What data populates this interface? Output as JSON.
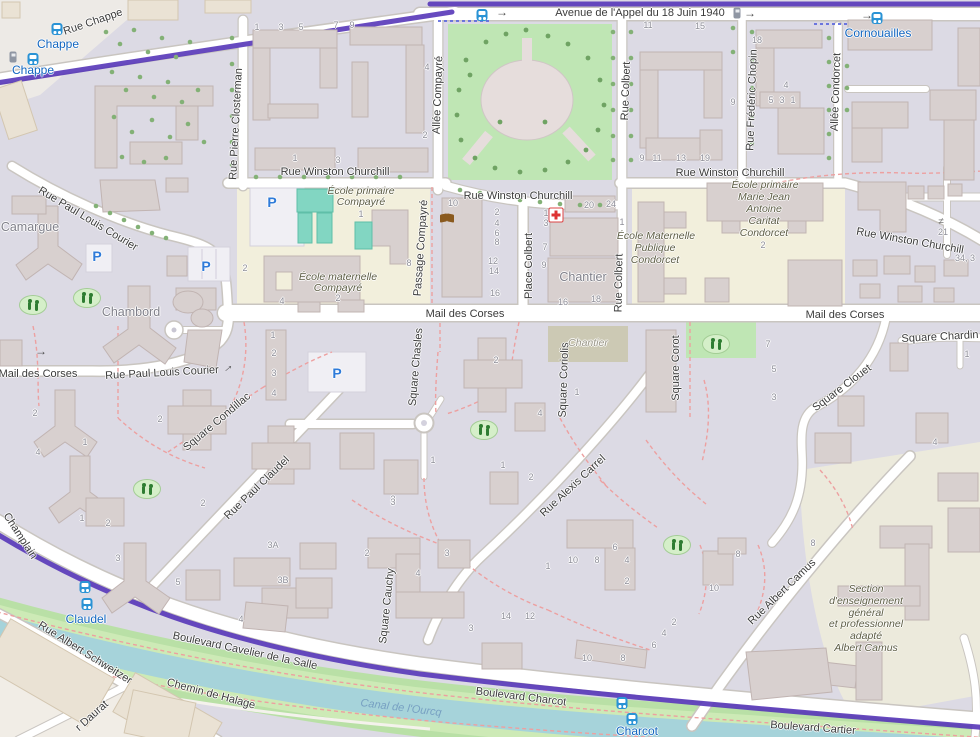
{
  "map": {
    "colors": {
      "residential": "#dcdae4",
      "route_purple": "#5636b8",
      "water": "#a6d3da",
      "park_green": "#bfe6b4",
      "school_beige": "#f2efdc",
      "pitch_teal": "#82d6c2",
      "stop_blue": "#1266c0",
      "building_gray": "#d8d0cf",
      "footpath_red": "#eda0a0"
    },
    "labels": {
      "streets": [
        {
          "t": "Avenue de l'Appel du 18 Juin 1940",
          "x": 640,
          "y": 13,
          "r": 0
        },
        {
          "t": "Rue Chappe",
          "x": 93,
          "y": 22,
          "r": -19
        },
        {
          "t": "Rue Pierre Closterman",
          "x": 236,
          "y": 124,
          "r": -87
        },
        {
          "t": "Allée Compayré",
          "x": 438,
          "y": 95,
          "r": -88
        },
        {
          "t": "Rue Winston Churchill",
          "x": 335,
          "y": 172,
          "r": 0
        },
        {
          "t": "Rue Winston Churchill",
          "x": 518,
          "y": 196,
          "r": 0
        },
        {
          "t": "Rue Winston Churchill",
          "x": 730,
          "y": 173,
          "r": 0
        },
        {
          "t": "Rue Winston Churchill",
          "x": 910,
          "y": 241,
          "r": 10
        },
        {
          "t": "Rue Colbert",
          "x": 626,
          "y": 91,
          "r": -88
        },
        {
          "t": "Rue Colbert",
          "x": 619,
          "y": 283,
          "r": -89
        },
        {
          "t": "Rue Frédéric Chopin",
          "x": 752,
          "y": 100,
          "r": -88
        },
        {
          "t": "Allée Condorcet",
          "x": 836,
          "y": 92,
          "r": -88
        },
        {
          "t": "Place Colbert",
          "x": 529,
          "y": 266,
          "r": -90
        },
        {
          "t": "Passage Compayré",
          "x": 421,
          "y": 248,
          "r": -86
        },
        {
          "t": "Mail des Corses",
          "x": 465,
          "y": 314,
          "r": 0
        },
        {
          "t": "Mail des Corses",
          "x": 845,
          "y": 315,
          "r": 0
        },
        {
          "t": "Mail des Corses",
          "x": 38,
          "y": 374,
          "r": 0
        },
        {
          "t": "Rue Paul Louis Courier",
          "x": 88,
          "y": 219,
          "r": 31
        },
        {
          "t": "Rue Paul Louis Courier",
          "x": 162,
          "y": 373,
          "r": -3
        },
        {
          "t": "Square Chardin",
          "x": 940,
          "y": 337,
          "r": -3
        },
        {
          "t": "Square Clouet",
          "x": 842,
          "y": 388,
          "r": -37
        },
        {
          "t": "Square Corot",
          "x": 676,
          "y": 368,
          "r": -90
        },
        {
          "t": "Square Condillac",
          "x": 217,
          "y": 422,
          "r": -40
        },
        {
          "t": "Rue Paul Claudel",
          "x": 257,
          "y": 488,
          "r": -44
        },
        {
          "t": "Square Chasles",
          "x": 416,
          "y": 367,
          "r": -85
        },
        {
          "t": "Square Coriolis",
          "x": 564,
          "y": 380,
          "r": -88
        },
        {
          "t": "Square Cauchy",
          "x": 387,
          "y": 606,
          "r": -84
        },
        {
          "t": "Rue Alexis Carrel",
          "x": 573,
          "y": 486,
          "r": -43
        },
        {
          "t": "Rue Albert Camus",
          "x": 782,
          "y": 592,
          "r": -44
        },
        {
          "t": "Boulevard Cavelier de la Salle",
          "x": 245,
          "y": 651,
          "r": 12
        },
        {
          "t": "Boulevard Charcot",
          "x": 521,
          "y": 697,
          "r": 7
        },
        {
          "t": "Boulevard Cartier",
          "x": 813,
          "y": 728,
          "r": 4
        },
        {
          "t": "Chemin de Halage",
          "x": 211,
          "y": 694,
          "r": 15
        },
        {
          "t": "Rue Albert Schweitzer",
          "x": 85,
          "y": 653,
          "r": 32
        },
        {
          "t": "r Daurat",
          "x": 92,
          "y": 716,
          "r": -42
        },
        {
          "t": "Champlain",
          "x": 20,
          "y": 536,
          "r": 57
        }
      ],
      "water": [
        {
          "t": "Canal de l'Ourcq",
          "x": 401,
          "y": 708,
          "r": 7
        }
      ],
      "places": [
        {
          "t": "Camargue",
          "x": 30,
          "y": 227,
          "r": 0
        },
        {
          "t": "Chambord",
          "x": 131,
          "y": 312,
          "r": 0
        },
        {
          "t": "Chantier",
          "x": 583,
          "y": 277,
          "r": 0
        }
      ],
      "areas": [
        {
          "t": "Chantier",
          "x": 588,
          "y": 343,
          "r": 0
        }
      ],
      "schools": [
        {
          "t": "École primaire",
          "x": 361,
          "y": 191,
          "r": 0
        },
        {
          "t": "Compayré",
          "x": 361,
          "y": 202,
          "r": 0
        },
        {
          "t": "École maternelle",
          "x": 338,
          "y": 277,
          "r": 0
        },
        {
          "t": "Compayré",
          "x": 338,
          "y": 288,
          "r": 0
        },
        {
          "t": "École Maternelle",
          "x": 656,
          "y": 236,
          "r": 0
        },
        {
          "t": "Publique",
          "x": 655,
          "y": 248,
          "r": 0
        },
        {
          "t": "Condorcet",
          "x": 655,
          "y": 260,
          "r": 0
        },
        {
          "t": "École primaire",
          "x": 765,
          "y": 185,
          "r": 0
        },
        {
          "t": "Marie Jean",
          "x": 764,
          "y": 197,
          "r": 0
        },
        {
          "t": "Antoine",
          "x": 764,
          "y": 209,
          "r": 0
        },
        {
          "t": "Caritat",
          "x": 764,
          "y": 221,
          "r": 0
        },
        {
          "t": "Condorcet",
          "x": 764,
          "y": 233,
          "r": 0
        },
        {
          "t": "Section",
          "x": 866,
          "y": 589,
          "r": 0
        },
        {
          "t": "d'enseignement",
          "x": 866,
          "y": 601,
          "r": 0
        },
        {
          "t": "général",
          "x": 866,
          "y": 613,
          "r": 0
        },
        {
          "t": "et professionnel",
          "x": 866,
          "y": 624,
          "r": 0
        },
        {
          "t": "adapté",
          "x": 866,
          "y": 636,
          "r": 0
        },
        {
          "t": "Albert Camus",
          "x": 866,
          "y": 648,
          "r": 0
        }
      ],
      "stops": [
        {
          "t": "Chappe",
          "x": 58,
          "y": 44,
          "r": 0
        },
        {
          "t": "Chappe",
          "x": 33,
          "y": 70,
          "r": 0
        },
        {
          "t": "Cornouailles",
          "x": 878,
          "y": 33,
          "r": 0
        },
        {
          "t": "Claudel",
          "x": 86,
          "y": 619,
          "r": 0
        },
        {
          "t": "Charcot",
          "x": 637,
          "y": 731,
          "r": 0
        }
      ],
      "numbers": [
        {
          "t": "1",
          "x": 257,
          "y": 27
        },
        {
          "t": "3",
          "x": 281,
          "y": 27
        },
        {
          "t": "5",
          "x": 301,
          "y": 27
        },
        {
          "t": "7",
          "x": 336,
          "y": 25
        },
        {
          "t": "9",
          "x": 352,
          "y": 25
        },
        {
          "t": "4",
          "x": 427,
          "y": 67
        },
        {
          "t": "2",
          "x": 425,
          "y": 135
        },
        {
          "t": "1",
          "x": 295,
          "y": 158
        },
        {
          "t": "3",
          "x": 338,
          "y": 160
        },
        {
          "t": "11",
          "x": 648,
          "y": 25
        },
        {
          "t": "15",
          "x": 700,
          "y": 26
        },
        {
          "t": "9",
          "x": 642,
          "y": 158
        },
        {
          "t": "11",
          "x": 657,
          "y": 158
        },
        {
          "t": "13",
          "x": 681,
          "y": 158
        },
        {
          "t": "19",
          "x": 705,
          "y": 158
        },
        {
          "t": "9",
          "x": 733,
          "y": 102
        },
        {
          "t": "18",
          "x": 757,
          "y": 40
        },
        {
          "t": "4",
          "x": 786,
          "y": 85
        },
        {
          "t": "5",
          "x": 771,
          "y": 100
        },
        {
          "t": "3",
          "x": 782,
          "y": 100
        },
        {
          "t": "1",
          "x": 793,
          "y": 100
        },
        {
          "t": "21",
          "x": 943,
          "y": 232
        },
        {
          "t": "34, 3",
          "x": 965,
          "y": 258
        },
        {
          "t": "1",
          "x": 361,
          "y": 214
        },
        {
          "t": "2",
          "x": 338,
          "y": 298
        },
        {
          "t": "4",
          "x": 282,
          "y": 301
        },
        {
          "t": "2",
          "x": 245,
          "y": 268
        },
        {
          "t": "8",
          "x": 409,
          "y": 263
        },
        {
          "t": "10",
          "x": 453,
          "y": 203
        },
        {
          "t": "2",
          "x": 497,
          "y": 212
        },
        {
          "t": "4",
          "x": 497,
          "y": 223
        },
        {
          "t": "6",
          "x": 497,
          "y": 233
        },
        {
          "t": "8",
          "x": 497,
          "y": 242
        },
        {
          "t": "12",
          "x": 493,
          "y": 261
        },
        {
          "t": "14",
          "x": 494,
          "y": 271
        },
        {
          "t": "16",
          "x": 495,
          "y": 293
        },
        {
          "t": "1",
          "x": 546,
          "y": 213
        },
        {
          "t": "3",
          "x": 546,
          "y": 223
        },
        {
          "t": "20",
          "x": 589,
          "y": 205
        },
        {
          "t": "24",
          "x": 611,
          "y": 204
        },
        {
          "t": "7",
          "x": 545,
          "y": 247
        },
        {
          "t": "9",
          "x": 544,
          "y": 265
        },
        {
          "t": "16",
          "x": 563,
          "y": 302
        },
        {
          "t": "18",
          "x": 596,
          "y": 299
        },
        {
          "t": "1",
          "x": 622,
          "y": 222
        },
        {
          "t": "2",
          "x": 763,
          "y": 245
        },
        {
          "t": "7",
          "x": 768,
          "y": 344
        },
        {
          "t": "5",
          "x": 774,
          "y": 369
        },
        {
          "t": "3",
          "x": 774,
          "y": 397
        },
        {
          "t": "1",
          "x": 967,
          "y": 354
        },
        {
          "t": "4",
          "x": 935,
          "y": 442
        },
        {
          "t": "2",
          "x": 35,
          "y": 413
        },
        {
          "t": "4",
          "x": 38,
          "y": 452
        },
        {
          "t": "1",
          "x": 85,
          "y": 442
        },
        {
          "t": "2",
          "x": 160,
          "y": 419
        },
        {
          "t": "2",
          "x": 203,
          "y": 503
        },
        {
          "t": "1",
          "x": 273,
          "y": 335
        },
        {
          "t": "2",
          "x": 274,
          "y": 353
        },
        {
          "t": "3",
          "x": 274,
          "y": 373
        },
        {
          "t": "4",
          "x": 274,
          "y": 393
        },
        {
          "t": "2",
          "x": 496,
          "y": 360
        },
        {
          "t": "4",
          "x": 540,
          "y": 413
        },
        {
          "t": "1",
          "x": 577,
          "y": 392
        },
        {
          "t": "1",
          "x": 433,
          "y": 460
        },
        {
          "t": "3",
          "x": 393,
          "y": 499
        },
        {
          "t": "1",
          "x": 503,
          "y": 465
        },
        {
          "t": "2",
          "x": 531,
          "y": 477
        },
        {
          "t": "1",
          "x": 82,
          "y": 518
        },
        {
          "t": "2",
          "x": 108,
          "y": 523
        },
        {
          "t": "3",
          "x": 118,
          "y": 558
        },
        {
          "t": "3A",
          "x": 273,
          "y": 545
        },
        {
          "t": "3B",
          "x": 283,
          "y": 580
        },
        {
          "t": "5",
          "x": 178,
          "y": 582
        },
        {
          "t": "4",
          "x": 241,
          "y": 619
        },
        {
          "t": "3",
          "x": 393,
          "y": 502
        },
        {
          "t": "2",
          "x": 367,
          "y": 553
        },
        {
          "t": "3",
          "x": 447,
          "y": 553
        },
        {
          "t": "4",
          "x": 418,
          "y": 573
        },
        {
          "t": "1",
          "x": 548,
          "y": 566
        },
        {
          "t": "14",
          "x": 506,
          "y": 616
        },
        {
          "t": "12",
          "x": 530,
          "y": 616
        },
        {
          "t": "3",
          "x": 471,
          "y": 628
        },
        {
          "t": "10",
          "x": 573,
          "y": 560
        },
        {
          "t": "8",
          "x": 597,
          "y": 560
        },
        {
          "t": "6",
          "x": 615,
          "y": 547
        },
        {
          "t": "4",
          "x": 627,
          "y": 560
        },
        {
          "t": "2",
          "x": 627,
          "y": 581
        },
        {
          "t": "2",
          "x": 674,
          "y": 622
        },
        {
          "t": "4",
          "x": 664,
          "y": 633
        },
        {
          "t": "6",
          "x": 654,
          "y": 645
        },
        {
          "t": "10",
          "x": 587,
          "y": 658
        },
        {
          "t": "8",
          "x": 623,
          "y": 658
        },
        {
          "t": "8",
          "x": 738,
          "y": 554
        },
        {
          "t": "10",
          "x": 714,
          "y": 588
        },
        {
          "t": "8",
          "x": 813,
          "y": 543
        }
      ]
    },
    "icons": {
      "bus": [
        {
          "x": 57,
          "y": 29
        },
        {
          "x": 33,
          "y": 59
        },
        {
          "x": 482,
          "y": 15
        },
        {
          "x": 877,
          "y": 18
        },
        {
          "x": 85,
          "y": 587
        },
        {
          "x": 87,
          "y": 604
        },
        {
          "x": 622,
          "y": 703
        },
        {
          "x": 632,
          "y": 719
        }
      ],
      "pole": [
        {
          "x": 737,
          "y": 13
        },
        {
          "x": 13,
          "y": 57
        }
      ],
      "parking": [
        {
          "t": "P",
          "x": 97,
          "y": 256
        },
        {
          "t": "P",
          "x": 206,
          "y": 266
        },
        {
          "t": "P",
          "x": 272,
          "y": 202
        },
        {
          "t": "P",
          "x": 337,
          "y": 373
        }
      ],
      "playground": [
        {
          "x": 33,
          "y": 305
        },
        {
          "x": 87,
          "y": 298
        },
        {
          "x": 147,
          "y": 489
        },
        {
          "x": 484,
          "y": 430
        },
        {
          "x": 716,
          "y": 344
        },
        {
          "x": 677,
          "y": 545
        }
      ],
      "pharmacy": [
        {
          "x": 556,
          "y": 215
        }
      ],
      "library": [
        {
          "x": 447,
          "y": 218
        }
      ],
      "arrow": [
        {
          "t": "→",
          "x": 502,
          "y": 12,
          "r": 0
        },
        {
          "t": "→",
          "x": 750,
          "y": 13,
          "r": 0
        },
        {
          "t": "→",
          "x": 867,
          "y": 15,
          "r": 0
        },
        {
          "t": "→",
          "x": 41,
          "y": 351,
          "r": 0
        },
        {
          "t": "→",
          "x": 227,
          "y": 367,
          "r": -40
        }
      ],
      "gate": [
        {
          "t": "≠",
          "x": 941,
          "y": 222,
          "r": 0
        }
      ]
    }
  }
}
